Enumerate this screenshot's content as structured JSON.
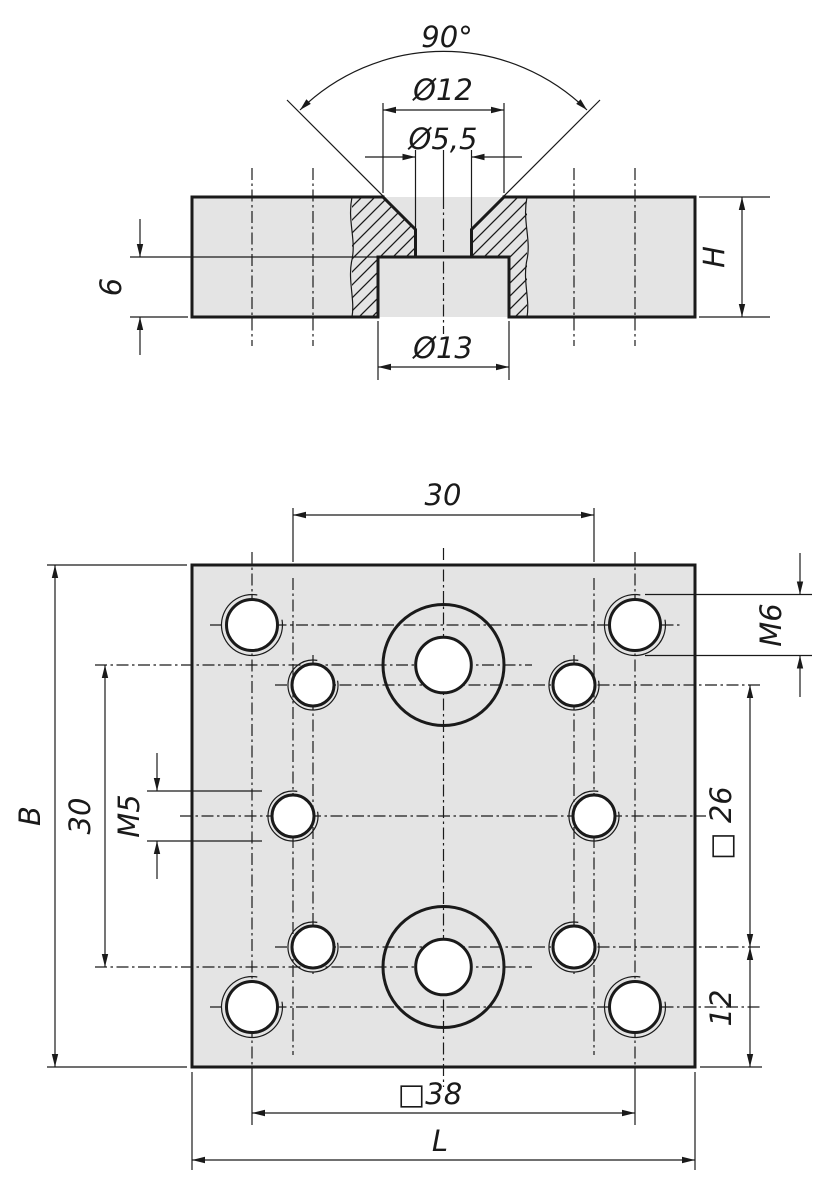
{
  "section": {
    "angle": "90°",
    "csk_dia": "Ø12",
    "hole_dia": "Ø5,5",
    "cbore_dia": "Ø13",
    "height": "H",
    "depth": "6"
  },
  "top": {
    "spacing_h": "30",
    "width": "B",
    "spacing_v": "30",
    "thread_small": "M5",
    "thread_corner": "M6",
    "square_inner": "□ 26",
    "edge_dist": "12",
    "square_outer": "□38",
    "length": "L"
  },
  "colors": {
    "background": "#ffffff",
    "plate_fill": "#e4e4e4",
    "line": "#1a1a1a"
  }
}
